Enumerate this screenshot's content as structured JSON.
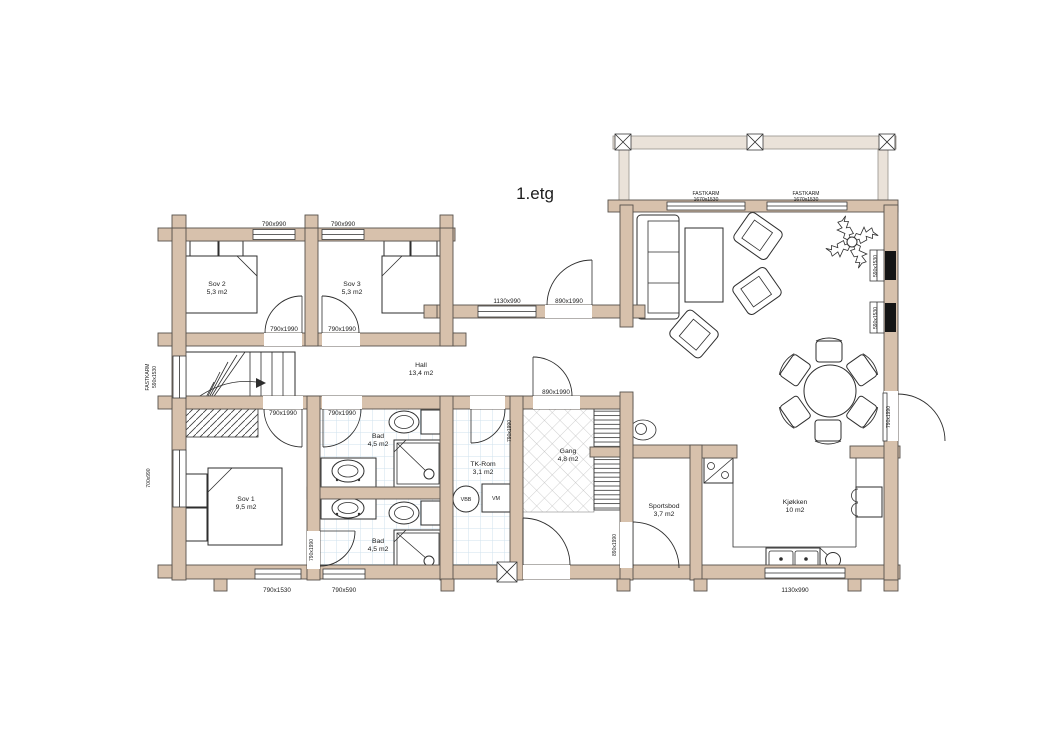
{
  "title": "1.etg",
  "rooms": {
    "sov2": {
      "name": "Sov 2",
      "area": "5,3 m2"
    },
    "sov3": {
      "name": "Sov 3",
      "area": "5,3 m2"
    },
    "sov1": {
      "name": "Sov 1",
      "area": "9,5 m2"
    },
    "hall": {
      "name": "Hall",
      "area": "13,4 m2"
    },
    "bad1": {
      "name": "Bad",
      "area": "4,5 m2"
    },
    "bad2": {
      "name": "Bad",
      "area": "4,5 m2"
    },
    "tkrom": {
      "name": "TK-Rom",
      "area": "3,1 m2"
    },
    "gang": {
      "name": "Gang",
      "area": "4,8 m2"
    },
    "sportsbod": {
      "name": "Sportsbod",
      "area": "3,7 m2"
    },
    "kjokken": {
      "name": "Kjøkken",
      "area": "10 m2"
    }
  },
  "appliances": {
    "vbb": "VBB",
    "vm": "VM"
  },
  "openings": {
    "sov2_window": "790x990",
    "sov3_window": "790x990",
    "stue_win1_line1": "FASTKARM",
    "stue_win1_line2": "1670x1530",
    "stue_win2_line1": "FASTKARM",
    "stue_win2_line2": "1670x1530",
    "stair_win_line1": "FASTKARM",
    "stair_win_line2": "590x1530",
    "hall_north_window": "1130x990",
    "hall_north_door": "890x1990",
    "sov2_door": "790x1990",
    "sov3_door": "790x1990",
    "sov1_door": "790x1990",
    "bad1_door": "790x1990",
    "tkrom_door": "790x1990",
    "gang_hall_door": "890x1990",
    "sov1_side_window": "700x990",
    "bad2_door": "790x1990",
    "sportsbod_door": "890x1990",
    "east_window1": "590x1530",
    "east_window2": "590x1530",
    "east_door": "790x1990",
    "sov1_bottom_window": "790x1530",
    "bad2_bottom_window": "790x590",
    "kjokken_window": "1130x990"
  },
  "colors": {
    "wall": "#d7c1ac",
    "beam": "#eae2d9",
    "tile_line": "#cfe2ee",
    "line": "#2e2e2e"
  }
}
